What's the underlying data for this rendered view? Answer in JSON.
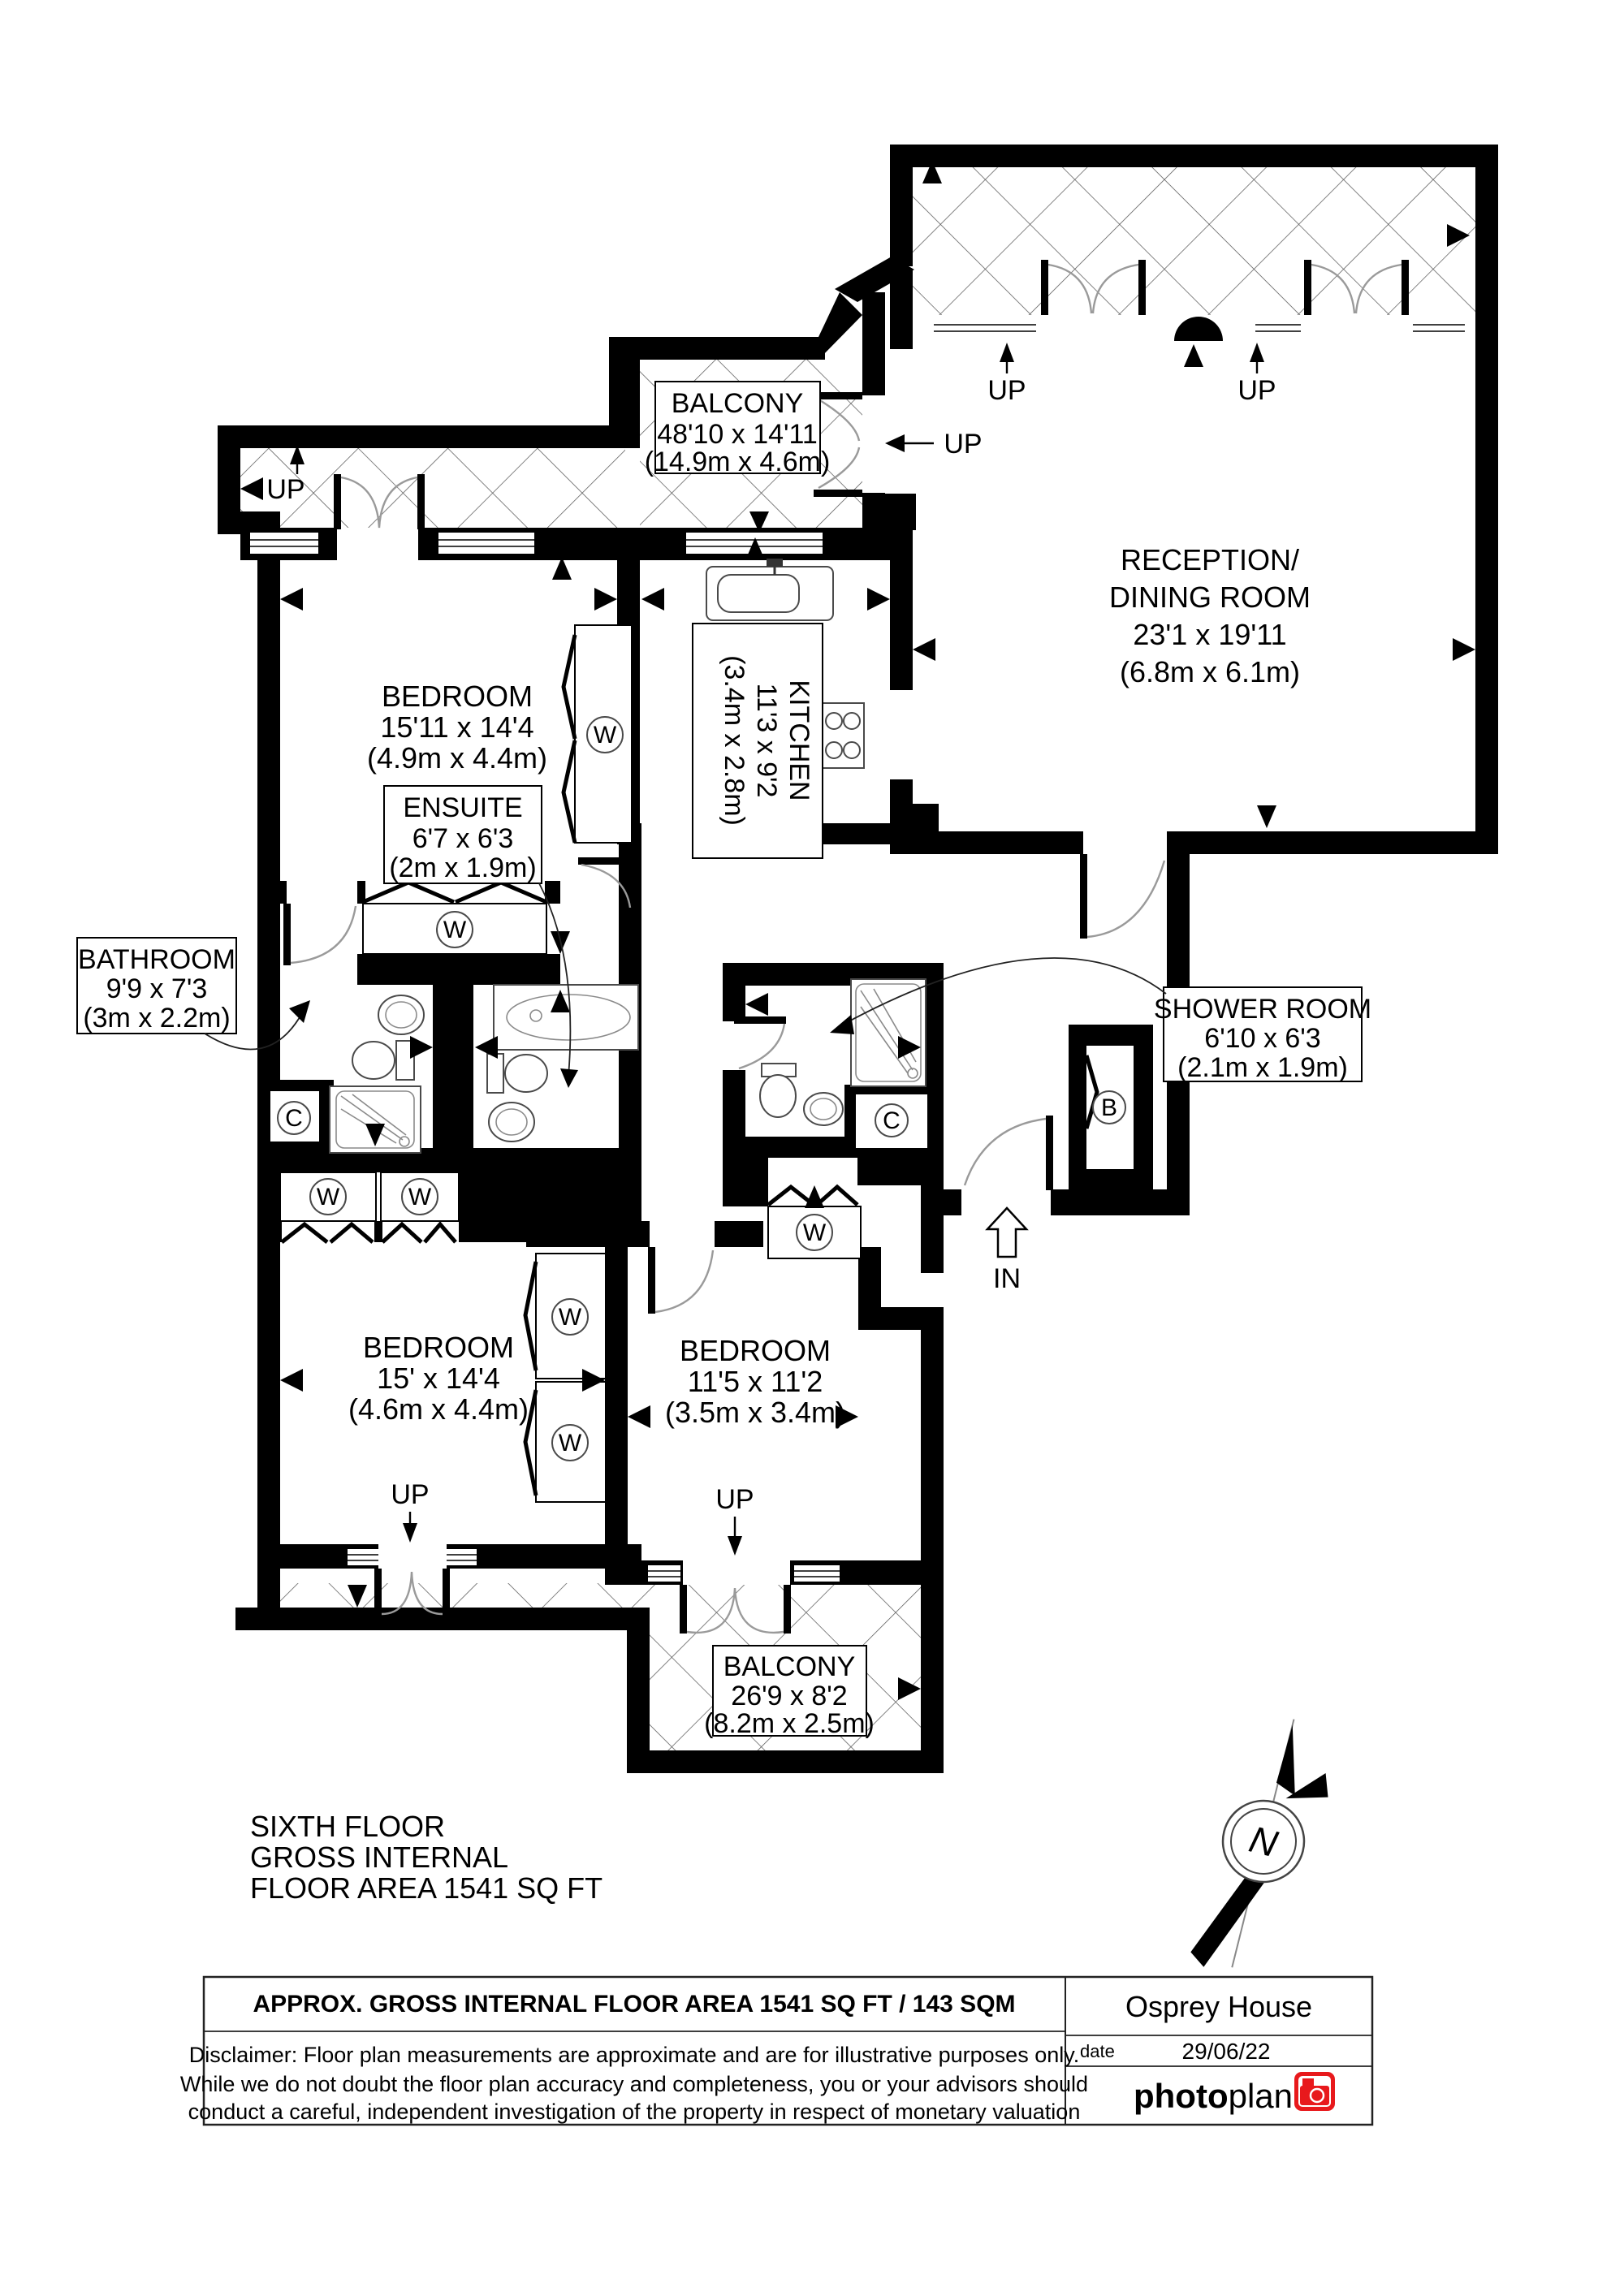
{
  "plan": {
    "rooms": {
      "balcony_top": {
        "name": "BALCONY",
        "imperial": "48'10 x 14'11",
        "metric": "(14.9m x 4.6m)"
      },
      "reception": {
        "name1": "RECEPTION/",
        "name2": "DINING ROOM",
        "imperial": "23'1 x 19'11",
        "metric": "(6.8m x 6.1m)"
      },
      "kitchen": {
        "name": "KITCHEN",
        "imperial": "11'3 x 9'2",
        "metric": "(3.4m x 2.8m)"
      },
      "bedroom_1": {
        "name": "BEDROOM",
        "imperial": "15'11 x 14'4",
        "metric": "(4.9m x 4.4m)"
      },
      "ensuite": {
        "name": "ENSUITE",
        "imperial": "6'7 x 6'3",
        "metric": "(2m x 1.9m)"
      },
      "bathroom": {
        "name": "BATHROOM",
        "imperial": "9'9 x 7'3",
        "metric": "(3m x 2.2m)"
      },
      "shower_room": {
        "name": "SHOWER ROOM",
        "imperial": "6'10 x 6'3",
        "metric": "(2.1m x 1.9m)"
      },
      "bedroom_2": {
        "name": "BEDROOM",
        "imperial": "15' x 14'4",
        "metric": "(4.6m x 4.4m)"
      },
      "bedroom_3": {
        "name": "BEDROOM",
        "imperial": "11'5 x 11'2",
        "metric": "(3.5m x 3.4m)"
      },
      "balcony_bottom": {
        "name": "BALCONY",
        "imperial": "26'9 x 8'2",
        "metric": "(8.2m x 2.5m)"
      }
    },
    "markers": {
      "up": "UP",
      "in": "IN",
      "north": "N",
      "wardrobe": "W",
      "cupboard": "C",
      "boiler": "B"
    },
    "floor_info": {
      "line1": "SIXTH FLOOR",
      "line2": "GROSS INTERNAL",
      "line3": "FLOOR AREA 1541 SQ FT"
    }
  },
  "footer": {
    "title": "APPROX. GROSS INTERNAL FLOOR AREA 1541 SQ FT / 143 SQM",
    "disclaimer_line1": "Disclaimer: Floor plan measurements are approximate and are for illustrative purposes only.",
    "disclaimer_line2": "While we do not doubt the floor plan accuracy and completeness, you or your advisors should",
    "disclaimer_line3": "conduct a careful, independent investigation of the property in respect of monetary valuation",
    "property_name": "Osprey House",
    "date_label": "date",
    "date_value": "29/06/22",
    "logo_text_bold": "photo",
    "logo_text_light": "plan",
    "logo_color": "#e8191c"
  }
}
